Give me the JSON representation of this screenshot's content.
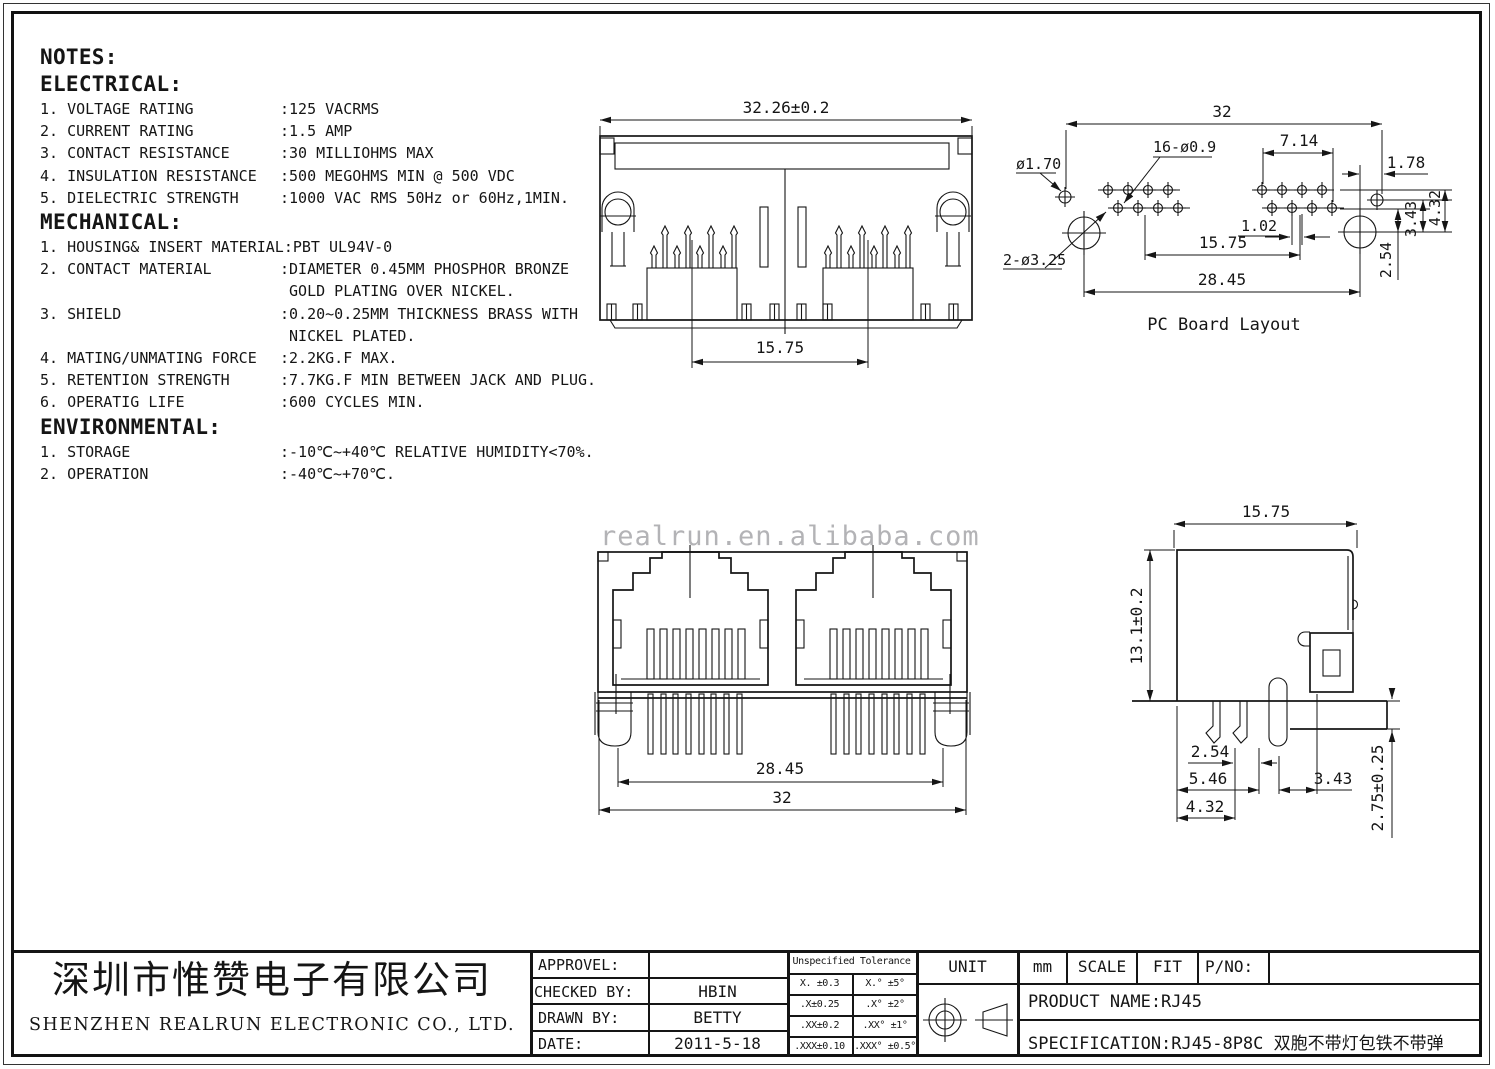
{
  "watermark": "realrun.en.alibaba.com",
  "notes": {
    "title": "NOTES:",
    "sections": [
      {
        "heading": "ELECTRICAL:",
        "items": [
          {
            "label": "1. VOLTAGE RATING",
            "value": ":125 VACRMS"
          },
          {
            "label": "2. CURRENT RATING",
            "value": ":1.5 AMP"
          },
          {
            "label": "3. CONTACT RESISTANCE",
            "value": ":30 MILLIOHMS MAX"
          },
          {
            "label": "4. INSULATION RESISTANCE",
            "value": ":500 MEGOHMS MIN @ 500 VDC"
          },
          {
            "label": "5. DIELECTRIC STRENGTH",
            "value": ":1000 VAC RMS 50Hz or 60Hz,1MIN."
          }
        ]
      },
      {
        "heading": "MECHANICAL:",
        "items": [
          {
            "label": "1. HOUSING& INSERT MATERIAL",
            "value": ":PBT UL94V-0"
          },
          {
            "label": "2. CONTACT MATERIAL",
            "value": ":DIAMETER 0.45MM PHOSPHOR BRONZE"
          },
          {
            "label": "",
            "value": " GOLD PLATING OVER NICKEL."
          },
          {
            "label": "3. SHIELD",
            "value": ":0.20~0.25MM THICKNESS BRASS WITH"
          },
          {
            "label": "",
            "value": " NICKEL PLATED."
          },
          {
            "label": "4. MATING/UNMATING FORCE",
            "value": ":2.2KG.F MAX."
          },
          {
            "label": "5. RETENTION STRENGTH",
            "value": ":7.7KG.F MIN BETWEEN JACK AND PLUG."
          },
          {
            "label": "6. OPERATIG LIFE",
            "value": ":600 CYCLES MIN."
          }
        ]
      },
      {
        "heading": "ENVIRONMENTAL:",
        "items": [
          {
            "label": "1. STORAGE",
            "value": ":-10℃~+40℃ RELATIVE HUMIDITY<70%."
          },
          {
            "label": "2. OPERATION",
            "value": ":-40℃~+70℃."
          }
        ]
      }
    ]
  },
  "drawings": {
    "top_view": {
      "dim_width": "32.26±0.2",
      "dim_pitch": "15.75"
    },
    "pcb_layout": {
      "caption": "PC Board Layout",
      "dim_overall": "32",
      "dim_group": "7.14",
      "dim_edge": "1.78",
      "label_hole_small": "ø1.70",
      "label_holes": "16-ø0.9",
      "dim_offset": "1.02",
      "dim_pitch": "15.75",
      "label_posts": "2-ø3.25",
      "dim_span": "28.45",
      "dim_row_a": "2.54",
      "dim_row_b": "3.43",
      "dim_row_c": "4.32"
    },
    "front_view": {
      "dim_span": "28.45",
      "dim_overall": "32"
    },
    "side_view": {
      "dim_depth": "15.75",
      "dim_height": "13.1±0.2",
      "dim_a": "2.54",
      "dim_b": "5.46",
      "dim_c": "4.32",
      "dim_d": "3.43",
      "dim_standoff": "2.75±0.25"
    }
  },
  "title_block": {
    "company_cn": "深圳市惟赞电子有限公司",
    "company_en": "SHENZHEN REALRUN ELECTRONIC CO., LTD.",
    "fields": [
      {
        "label": "APPROVEL:",
        "value": ""
      },
      {
        "label": "CHECKED BY:",
        "value": "HBIN"
      },
      {
        "label": "DRAWN BY:",
        "value": "BETTY"
      },
      {
        "label": "DATE:",
        "value": "2011-5-18"
      }
    ],
    "tolerance": {
      "header": "Unspecified Tolerance",
      "rows": [
        [
          "X. ±0.3",
          "X.° ±5°"
        ],
        [
          ".X±0.25",
          ".X° ±2°"
        ],
        [
          ".XX±0.2",
          ".XX° ±1°"
        ],
        [
          ".XXX±0.10",
          ".XXX° ±0.5°"
        ]
      ]
    },
    "unit_label": "UNIT",
    "unit_value": "mm",
    "scale_label": "SCALE",
    "scale_value": "FIT",
    "pno_label": "P/NO:",
    "product": "PRODUCT NAME:RJ45",
    "specification": "SPECIFICATION:RJ45-8P8C 双胞不带灯包铁不带弹"
  }
}
